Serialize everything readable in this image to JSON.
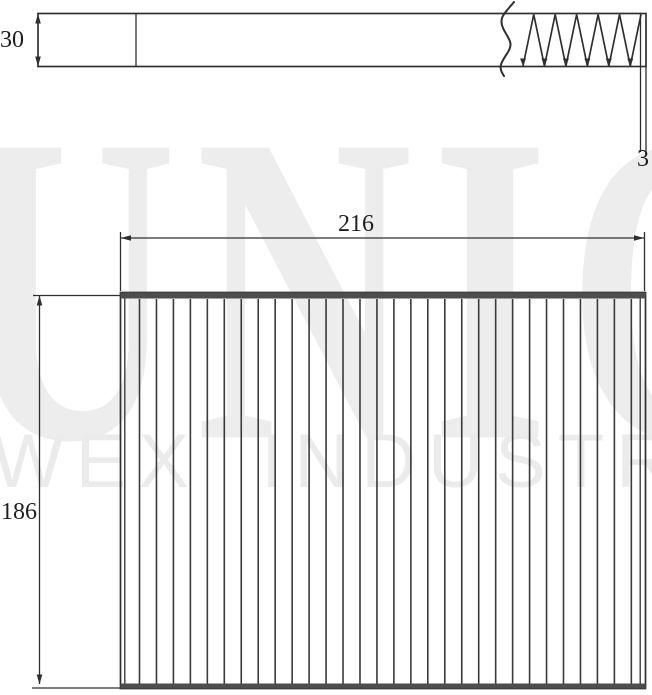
{
  "watermark": {
    "primary": "UNIC",
    "secondary": "WEX INDUSTRIES"
  },
  "dimensions": {
    "side_height": "30",
    "edge_width": "3",
    "overall_width": "216",
    "overall_height": "186"
  },
  "drawing": {
    "pleat_line_count": 30,
    "pleat_first_x": 139.5,
    "pleat_spacing": 16.96,
    "pleat_top_y": 299,
    "pleat_bottom_y": 683.5,
    "zigzag_tooth_count": 6,
    "zigzag_start_x": 523,
    "zigzag_end_x": 641,
    "zigzag_top_y": 14.5,
    "zigzag_bottom_y": 66,
    "line_color": "#2f2f2f",
    "frame_band_color": "#4d4d4d",
    "pleat_color": "#3a3a3a",
    "label_color": "#1e1e1e",
    "watermark_primary_color": "#ededed",
    "watermark_secondary_color": "#ebebeb"
  }
}
